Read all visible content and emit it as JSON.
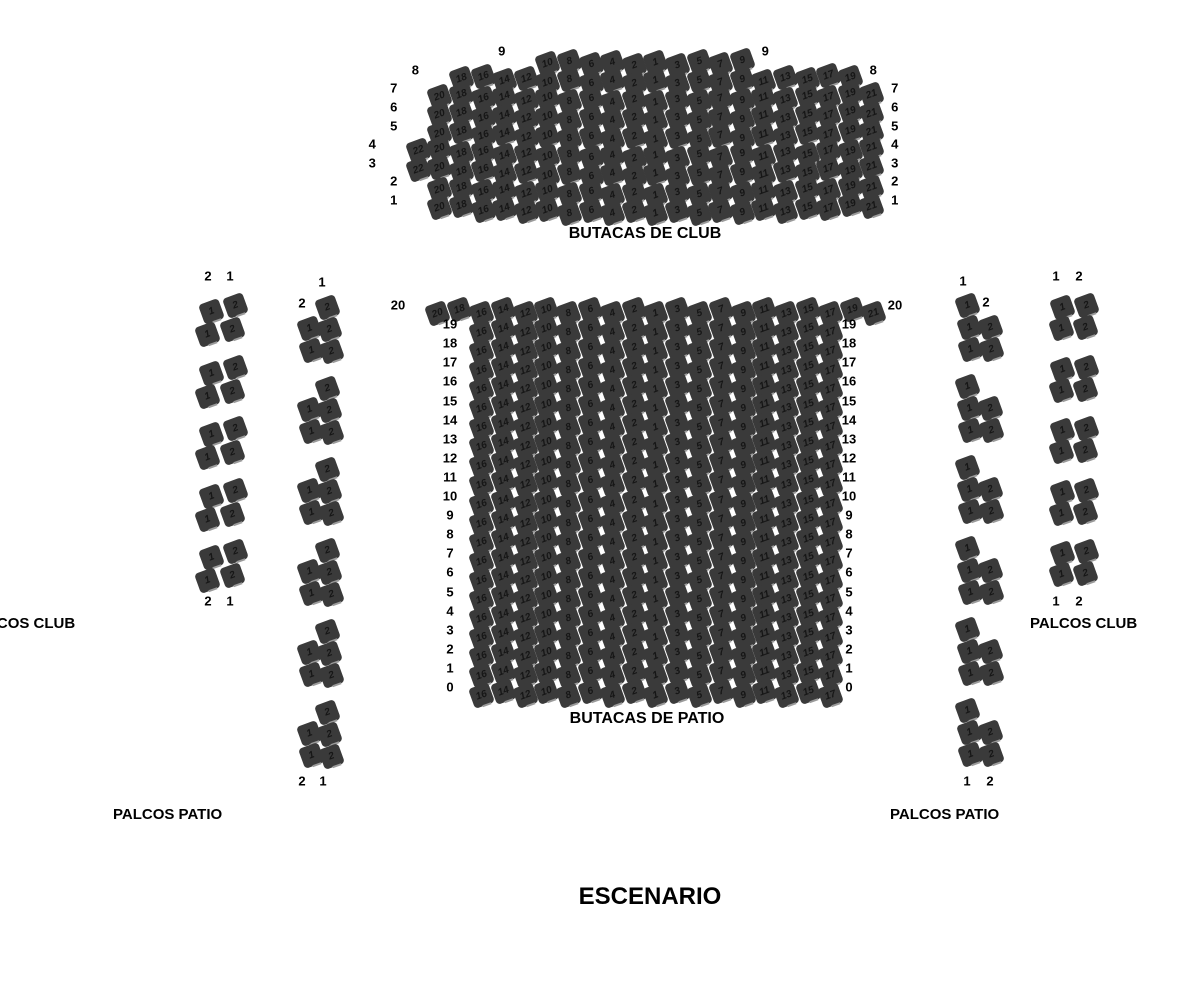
{
  "stage_label": "ESCENARIO",
  "club": {
    "title": "BUTACAS DE CLUB",
    "rows": [
      {
        "row": "9",
        "even_start": 10,
        "odd_end": 9
      },
      {
        "row": "8",
        "even_start": 18,
        "odd_end": 19
      },
      {
        "row": "7",
        "even_start": 20,
        "odd_end": 21
      },
      {
        "row": "6",
        "even_start": 20,
        "odd_end": 21
      },
      {
        "row": "5",
        "even_start": 20,
        "odd_end": 21
      },
      {
        "row": "4",
        "even_start": 22,
        "odd_end": 21
      },
      {
        "row": "3",
        "even_start": 22,
        "odd_end": 21
      },
      {
        "row": "2",
        "even_start": 20,
        "odd_end": 21
      },
      {
        "row": "1",
        "even_start": 20,
        "odd_end": 21
      }
    ]
  },
  "patio": {
    "title": "BUTACAS DE PATIO",
    "rows": [
      {
        "row": "20",
        "even_start": 20,
        "odd_end": 21
      },
      {
        "row": "19",
        "even_start": 16,
        "odd_end": 17
      },
      {
        "row": "18",
        "even_start": 16,
        "odd_end": 17
      },
      {
        "row": "17",
        "even_start": 16,
        "odd_end": 17
      },
      {
        "row": "16",
        "even_start": 16,
        "odd_end": 17
      },
      {
        "row": "15",
        "even_start": 16,
        "odd_end": 17
      },
      {
        "row": "14",
        "even_start": 16,
        "odd_end": 17
      },
      {
        "row": "13",
        "even_start": 16,
        "odd_end": 17
      },
      {
        "row": "12",
        "even_start": 16,
        "odd_end": 17
      },
      {
        "row": "11",
        "even_start": 16,
        "odd_end": 17
      },
      {
        "row": "10",
        "even_start": 16,
        "odd_end": 17
      },
      {
        "row": "9",
        "even_start": 16,
        "odd_end": 17
      },
      {
        "row": "8",
        "even_start": 16,
        "odd_end": 17
      },
      {
        "row": "7",
        "even_start": 16,
        "odd_end": 17
      },
      {
        "row": "6",
        "even_start": 16,
        "odd_end": 17
      },
      {
        "row": "5",
        "even_start": 16,
        "odd_end": 17
      },
      {
        "row": "4",
        "even_start": 16,
        "odd_end": 17
      },
      {
        "row": "3",
        "even_start": 16,
        "odd_end": 17
      },
      {
        "row": "2",
        "even_start": 16,
        "odd_end": 17
      },
      {
        "row": "1",
        "even_start": 16,
        "odd_end": 17
      },
      {
        "row": "0",
        "even_start": 16,
        "odd_end": 17
      }
    ]
  },
  "palcos": {
    "club_left": {
      "label": "PALCOS CLUB",
      "header": [
        "2",
        "1"
      ],
      "footer": [
        "2",
        "1"
      ],
      "box_count": 5,
      "box_seats": [
        "1",
        "2",
        "1",
        "2"
      ]
    },
    "patio_left": {
      "label": "PALCOS PATIO",
      "header": [
        "1",
        "2"
      ],
      "footer": [
        "2",
        "1"
      ],
      "box_count": 6,
      "box_seats": [
        "2",
        "1",
        "2",
        "1",
        "2"
      ]
    },
    "club_right": {
      "label": "PALCOS CLUB",
      "header": [
        "1",
        "2"
      ],
      "footer": [
        "1",
        "2"
      ],
      "box_count": 5,
      "box_seats": [
        "1",
        "2",
        "1",
        "2"
      ]
    },
    "patio_right": {
      "label": "PALCOS PATIO",
      "header": [
        "1",
        "2"
      ],
      "footer": [
        "1",
        "2"
      ],
      "box_count": 6,
      "box_seats": [
        "1",
        "1",
        "2",
        "1",
        "2"
      ]
    }
  },
  "colors": {
    "seat": "#3a3a3a",
    "seat_number": "#161616",
    "seat_tag": "#9a9a9a",
    "label": "#000000",
    "background": "#ffffff"
  }
}
